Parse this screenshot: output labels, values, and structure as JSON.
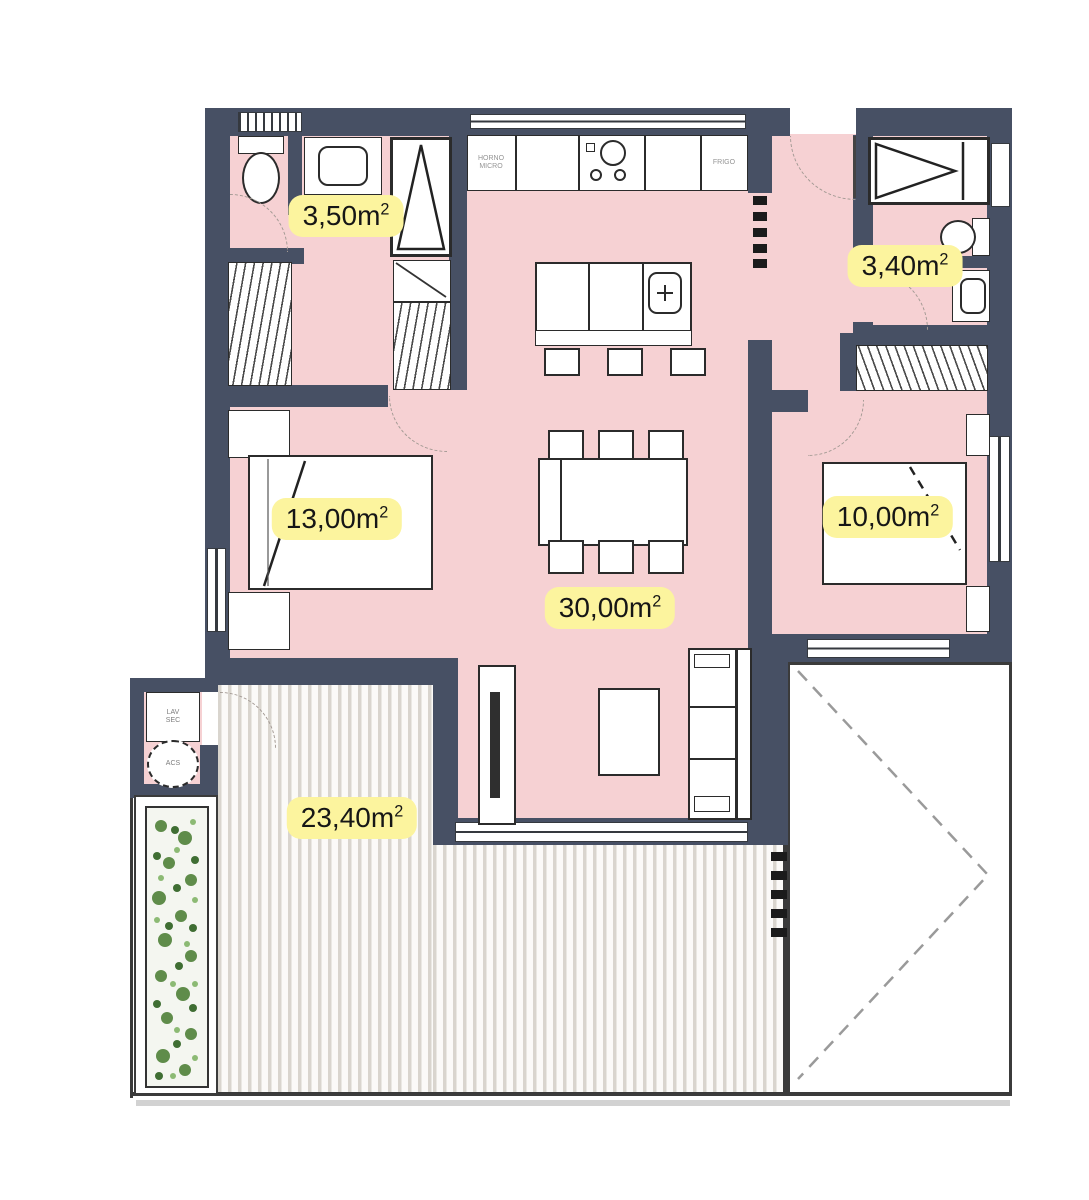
{
  "colors": {
    "wall": "#475064",
    "floor": "#f6d1d3",
    "label_background": "#fcf49e",
    "label_text": "#161616",
    "furniture_outline": "#2b2b2b",
    "terrace_stripe": "#d9d5ce",
    "plant_green": "#5f8c4a"
  },
  "room_labels": [
    {
      "room": "bathroom-1",
      "area": "3,50m",
      "sup": "2"
    },
    {
      "room": "bathroom-2",
      "area": "3,40m",
      "sup": "2"
    },
    {
      "room": "bedroom-main",
      "area": "13,00m",
      "sup": "2"
    },
    {
      "room": "bedroom-2",
      "area": "10,00m",
      "sup": "2"
    },
    {
      "room": "living-dining-kitchen",
      "area": "30,00m",
      "sup": "2"
    },
    {
      "room": "terrace",
      "area": "23,40m",
      "sup": "2"
    }
  ],
  "appliances": {
    "oven_line1": "HORNO",
    "oven_line2": "MICRO",
    "fridge": "FRIGO",
    "washer_line1": "LAV",
    "washer_line2": "SEC",
    "water_heater": "ACS"
  }
}
